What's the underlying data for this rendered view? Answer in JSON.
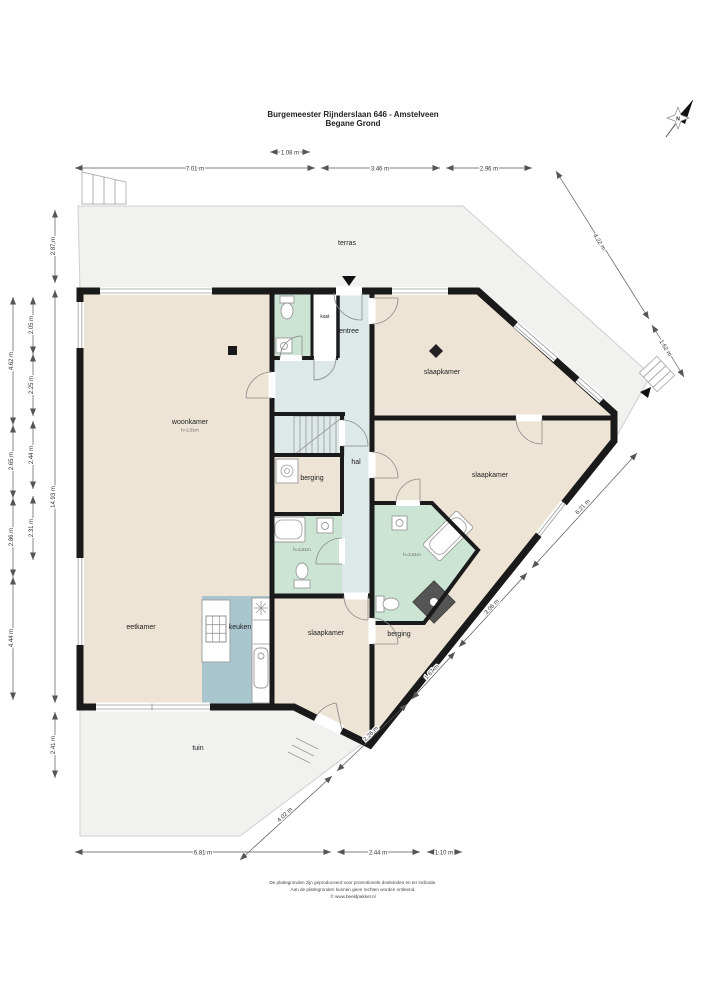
{
  "title": {
    "line1": "Burgemeester Rijnderslaan 646 - Amstelveen",
    "line2": "Begane Grond"
  },
  "compass": {
    "north": "N"
  },
  "rooms": {
    "terras": "terras",
    "tuin": "tuin",
    "woonkamer": {
      "label": "woonkamer",
      "height": "h=2,91m"
    },
    "eetkamer": "eetkamer",
    "keuken": "keuken",
    "entree": "entree",
    "hal": "hal",
    "kast": "kast",
    "berging_hal": "berging",
    "berging_rechts": "berging",
    "slaapkamer_1": "slaapkamer",
    "slaapkamer_2": "slaapkamer",
    "slaapkamer_3": "slaapkamer",
    "badkamer_1": {
      "height": "h=2,61m"
    },
    "badkamer_2": {
      "height": "h=2,61m"
    }
  },
  "dims": {
    "door_width": "1.08 m",
    "top": [
      "7.01 m",
      "3.46 m",
      "2.96 m"
    ],
    "bottom": [
      "6.81 m",
      "2.44 m",
      "1.10 m"
    ],
    "left_inner": [
      "2.87 m",
      "14.93 m",
      "2.41 m"
    ],
    "left_middle": [
      "2.05 m",
      "2.25 m",
      "2.44 m",
      "2.31 m"
    ],
    "left_outer": [
      "4.62 m",
      "2.65 m",
      "2.86 m",
      "4.44 m"
    ],
    "right_diag": [
      "4.22 m",
      "1.62 m"
    ],
    "southeast_diag": [
      "6.21 m",
      "3.06 m",
      "1.67 m",
      "2.26 m",
      "4.02 m"
    ]
  },
  "footer": {
    "line1": "De plattegronden zijn geproduceerd voor promotionele doeleinden en ter indicatie.",
    "line2": "Aan de plattegronden kunnen geen rechten worden ontleend.",
    "line3": "© www.beeldpakket.nl"
  },
  "colors": {
    "room_beige": "#EDE4D5",
    "wet_room_green": "#CCE4D4",
    "kitchen_blue": "#A9C6CF",
    "hall_blue": "#DDE8E9",
    "outdoor_gray": "#F1F1F0",
    "wall_black": "#1A1A1A"
  }
}
